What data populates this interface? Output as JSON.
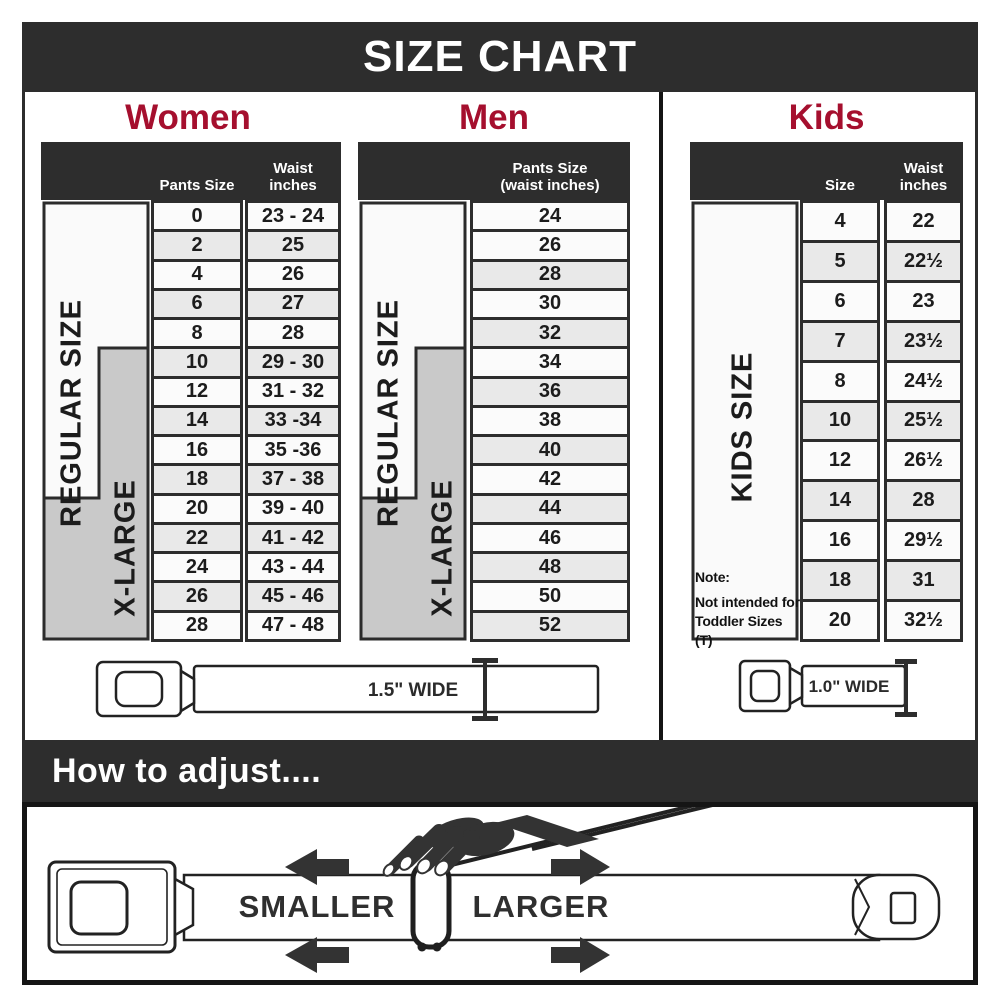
{
  "title": "SIZE CHART",
  "colors": {
    "banner_bg": "#2d2d2d",
    "heading_accent": "#a50f2e",
    "row_light": "#fbfbfb",
    "row_shaded": "#e9e9e9",
    "xlarge_box": "#c9c9c9",
    "regular_box": "#fafafa"
  },
  "women": {
    "heading": "Women",
    "col1_header": "Pants Size",
    "col2_header": {
      "line1": "Waist",
      "line2": "inches"
    },
    "regular_label": "REGULAR SIZE",
    "xlarge_label": "X-LARGE",
    "belt_width_label": "1.5\" WIDE",
    "rows": [
      {
        "size": "0",
        "waist": "23 - 24"
      },
      {
        "size": "2",
        "waist": "25"
      },
      {
        "size": "4",
        "waist": "26"
      },
      {
        "size": "6",
        "waist": "27"
      },
      {
        "size": "8",
        "waist": "28"
      },
      {
        "size": "10",
        "waist": "29 - 30"
      },
      {
        "size": "12",
        "waist": "31 - 32"
      },
      {
        "size": "14",
        "waist": "33 -34"
      },
      {
        "size": "16",
        "waist": "35 -36"
      },
      {
        "size": "18",
        "waist": "37 - 38"
      },
      {
        "size": "20",
        "waist": "39 - 40"
      },
      {
        "size": "22",
        "waist": "41 - 42"
      },
      {
        "size": "24",
        "waist": "43 - 44"
      },
      {
        "size": "26",
        "waist": "45 - 46"
      },
      {
        "size": "28",
        "waist": "47 - 48"
      }
    ]
  },
  "men": {
    "heading": "Men",
    "col_header": {
      "line1": "Pants Size",
      "line2": "(waist inches)"
    },
    "regular_label": "REGULAR SIZE",
    "xlarge_label": "X-LARGE",
    "rows": [
      "24",
      "26",
      "28",
      "30",
      "32",
      "34",
      "36",
      "38",
      "40",
      "42",
      "44",
      "46",
      "48",
      "50",
      "52"
    ]
  },
  "kids": {
    "heading": "Kids",
    "col1_header": "Size",
    "col2_header": {
      "line1": "Waist",
      "line2": "inches"
    },
    "side_label": "KIDS SIZE",
    "belt_width_label": "1.0\" WIDE",
    "note": {
      "line1": "Note:",
      "line2": "Not intended for",
      "line3": "Toddler Sizes (T)"
    },
    "rows": [
      {
        "size": "4",
        "waist": "22"
      },
      {
        "size": "5",
        "waist": "22½"
      },
      {
        "size": "6",
        "waist": "23"
      },
      {
        "size": "7",
        "waist": "23½"
      },
      {
        "size": "8",
        "waist": "24½"
      },
      {
        "size": "10",
        "waist": "25½"
      },
      {
        "size": "12",
        "waist": "26½"
      },
      {
        "size": "14",
        "waist": "28"
      },
      {
        "size": "16",
        "waist": "29½"
      },
      {
        "size": "18",
        "waist": "31"
      },
      {
        "size": "20",
        "waist": "32½"
      }
    ]
  },
  "adjust": {
    "heading": "How to adjust....",
    "smaller_label": "SMALLER",
    "larger_label": "LARGER"
  }
}
